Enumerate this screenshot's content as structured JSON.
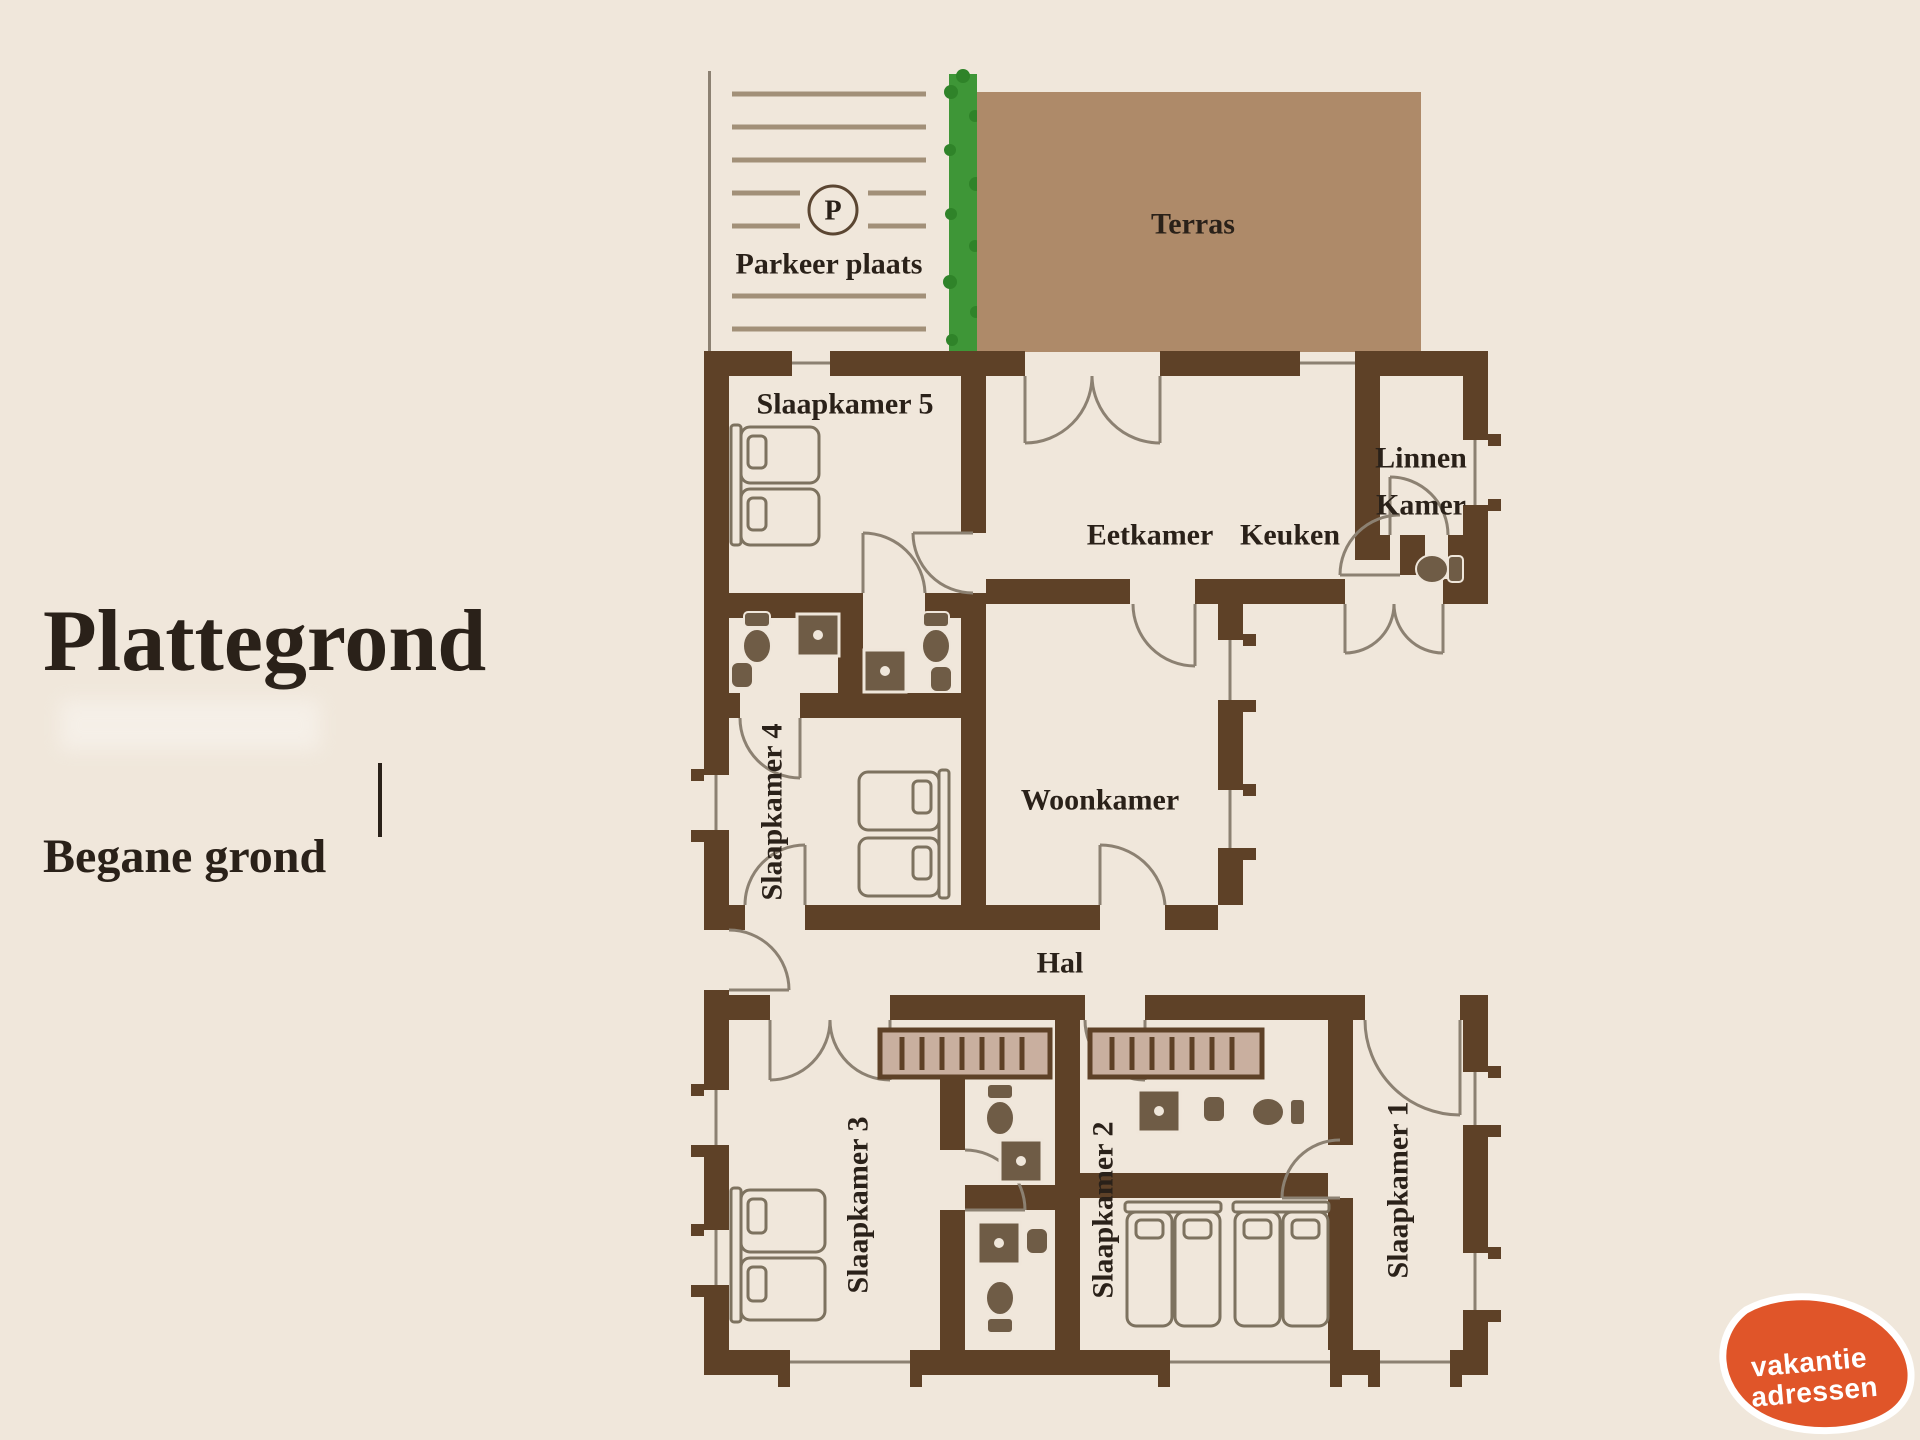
{
  "title": "Plattegrond",
  "subtitle": "Begane grond",
  "colors": {
    "bg": "#F0E7DB",
    "wall": "#5E4127",
    "terras": "#AE8A69",
    "hedge": "#3E9637",
    "hedge_dark": "#2F8329",
    "line": "#8C8172",
    "fixture": "#6F5C46",
    "fixture_edge": "#EFE6DA",
    "furniture": "#7D725F",
    "wardrobe": "#C9AF9F",
    "parking_line": "#A29078",
    "text": "#2A2119",
    "logo": "#E05529"
  },
  "outdoor": {
    "terras_label": "Terras",
    "parking_label": "Parkeer plaats",
    "parking_symbol": "P"
  },
  "rooms": {
    "slaapkamer5": "Slaapkamer 5",
    "eetkamer": "Eetkamer",
    "keuken": "Keuken",
    "linnen_line1": "Linnen",
    "linnen_line2": "Kamer",
    "slaapkamer4": "Slaapkamer 4",
    "woonkamer": "Woonkamer",
    "hal": "Hal",
    "slaapkamer3": "Slaapkamer 3",
    "slaapkamer2": "Slaapkamer 2",
    "slaapkamer1": "Slaapkamer 1"
  },
  "logo": {
    "line1": "vakantie",
    "line2": "adressen"
  }
}
